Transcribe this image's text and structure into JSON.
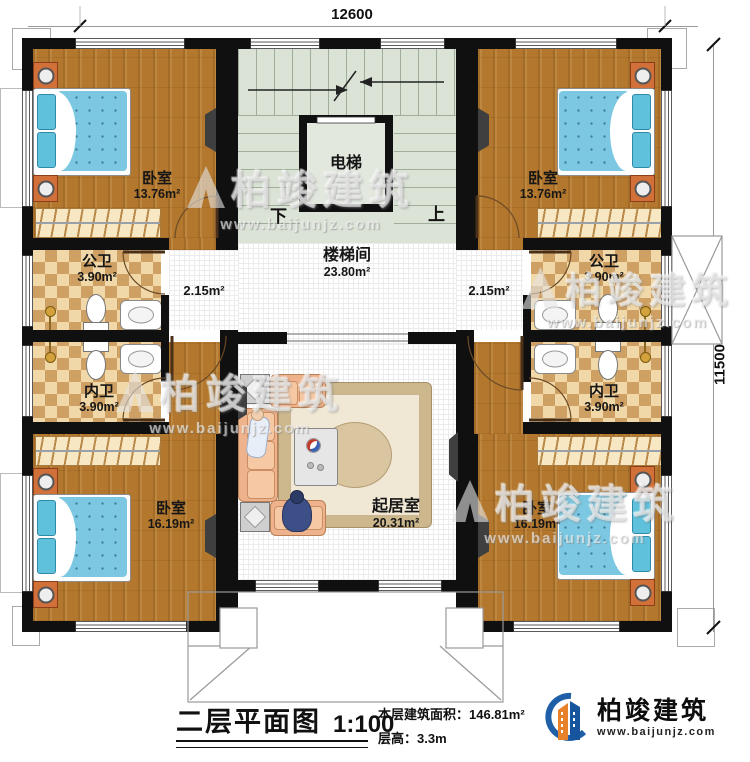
{
  "dimensions": {
    "width_mm": "12600",
    "height_mm": "11500"
  },
  "rooms": {
    "bedroom_tl": {
      "name": "卧室",
      "area": "13.76m²"
    },
    "bedroom_tr": {
      "name": "卧室",
      "area": "13.76m²"
    },
    "bedroom_bl": {
      "name": "卧室",
      "area": "16.19m²"
    },
    "bedroom_br": {
      "name": "卧室",
      "area": "16.19m²"
    },
    "bath_public_left": {
      "name": "公卫",
      "area": "3.90m²"
    },
    "bath_public_right": {
      "name": "公卫",
      "area": "3.90m²"
    },
    "bath_private_left": {
      "name": "内卫",
      "area": "3.90m²"
    },
    "bath_private_right": {
      "name": "内卫",
      "area": "3.90m²"
    },
    "stair_hall": {
      "name": "楼梯间",
      "area": "23.80m²"
    },
    "living": {
      "name": "起居室",
      "area": "20.31m²"
    },
    "elevator": {
      "name": "电梯"
    },
    "passage_left": {
      "area": "2.15m²"
    },
    "passage_right": {
      "area": "2.15m²"
    }
  },
  "stairs": {
    "down_label": "下",
    "up_label": "上"
  },
  "title_block": {
    "title": "二层平面图",
    "scale": "1:100",
    "floor_area": "本层建筑面积：146.81m²",
    "floor_height": "层高：3.3m"
  },
  "brand": {
    "name": "柏竣建筑",
    "url": "www.baijunjz.com"
  },
  "watermark": {
    "name": "柏竣建筑",
    "url": "www.baijunjz.com"
  },
  "colors": {
    "wall": "#101010",
    "wood": "#b3782e",
    "tile_light": "#f0d8a8",
    "tile_dark": "#cfa064",
    "stair": "#dbe2d6",
    "brand_blue": "#1f5fa8",
    "brand_orange": "#e8822a"
  }
}
